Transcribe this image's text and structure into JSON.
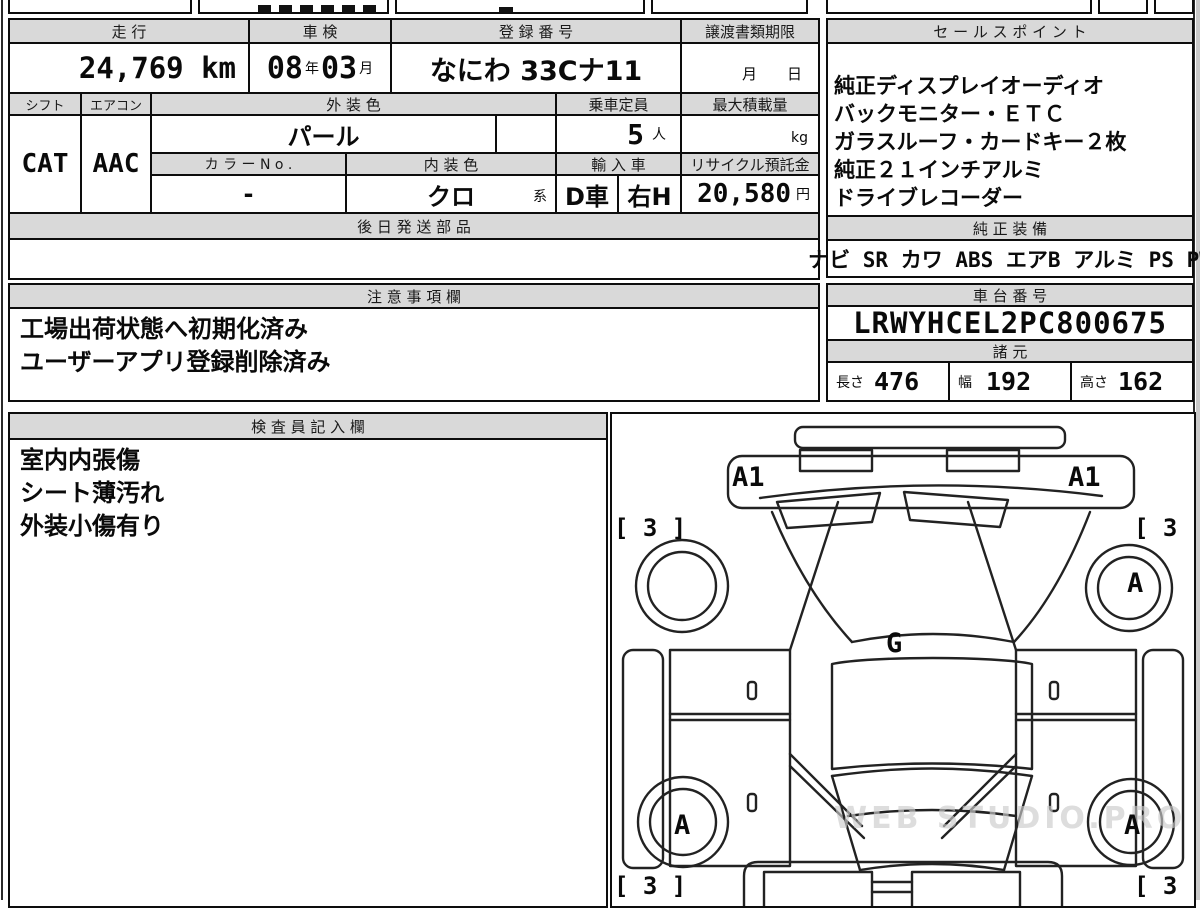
{
  "colors": {
    "header_bg": "#d9d9d9",
    "border": "#000000",
    "watermark": "#cccccc"
  },
  "vehicle": {
    "mileage": {
      "label": "走 行",
      "value": "24,769 km"
    },
    "inspection": {
      "label": "車 検",
      "year": "08",
      "year_unit": "年",
      "month": "03",
      "month_unit": "月"
    },
    "registration": {
      "label": "登 録 番 号",
      "value": "なにわ 33Cナ11"
    },
    "transfer_docs": {
      "label": "譲渡書類期限",
      "month_unit": "月",
      "day_unit": "日"
    },
    "shift": {
      "label": "シフト",
      "value": "CAT"
    },
    "aircon": {
      "label": "エアコン",
      "value": "AAC"
    },
    "exterior_color": {
      "label": "外 装 色",
      "value": "パール"
    },
    "capacity": {
      "label": "乗車定員",
      "value": "5",
      "unit": "人"
    },
    "max_load": {
      "label": "最大積載量",
      "value": "",
      "unit": "kg"
    },
    "color_no": {
      "label": "カ ラ ー N o .",
      "value": "-"
    },
    "interior_color": {
      "label": "内 装 色",
      "value": "クロ",
      "suffix": "系"
    },
    "import_car": {
      "label": "輸 入 車",
      "type": "D車",
      "handle": "右H"
    },
    "recycle_deposit": {
      "label": "リサイクル預託金",
      "value": "20,580",
      "unit": "円"
    },
    "later_shipping_parts": {
      "label": "後 日 発 送 部 品",
      "value": ""
    }
  },
  "notes": {
    "label": "注 意 事 項 欄",
    "lines": [
      "工場出荷状態へ初期化済み",
      "ユーザーアプリ登録削除済み"
    ]
  },
  "sales_points": {
    "label": "セ ー ル ス ポ イ ン ト",
    "lines": [
      "純正ディスプレイオーディオ",
      "バックモニター・ＥＴＣ",
      "ガラスルーフ・カードキー２枚",
      "純正２１インチアルミ",
      "ドライブレコーダー"
    ]
  },
  "equipment": {
    "label": "純 正 装 備",
    "value": "ナビ SR カワ ABS エアB アルミ PS PW"
  },
  "chassis_no": {
    "label": "車 台 番 号",
    "value": "LRWYHCEL2PC800675"
  },
  "dimensions": {
    "label": "諸 元",
    "length_label": "長さ",
    "length": "476",
    "width_label": "幅",
    "width": "192",
    "height_label": "高さ",
    "height": "162"
  },
  "inspector_notes": {
    "label": "検 査 員 記 入 欄",
    "lines": [
      "室内内張傷",
      "シート薄汚れ",
      "外装小傷有り"
    ]
  },
  "diagram": {
    "front_bumper_left": "A1",
    "front_bumper_right": "A1",
    "front_fender_left": "[ 3 ]",
    "front_fender_right": "[ 3 ]",
    "front_wheel_right": "A",
    "glass": "G",
    "rear_wheel_left": "A",
    "rear_wheel_right": "A",
    "rear_fender_left": "[ 3 ]",
    "rear_fender_right": "[ 3 ]",
    "watermark": "WEB STUDIO.PRO"
  }
}
